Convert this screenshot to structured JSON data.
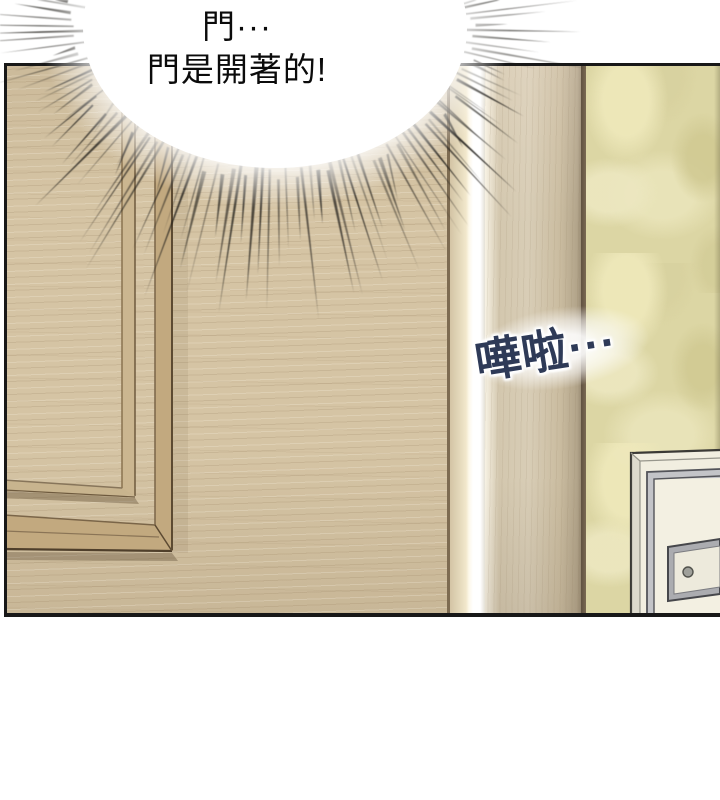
{
  "speech_bubble": {
    "lines": [
      "門···",
      "門是開著的!"
    ]
  },
  "sfx": {
    "text": "嘩啦···"
  },
  "theme": {
    "page_bg": "#ffffff",
    "panel_border": "#181818",
    "door_wood": "#d5c4a4",
    "door_grain": "#967e5c",
    "molding_face": "#c2a97f",
    "molding_line": "#5c4a32",
    "door_edge_light": "#f2e8cc",
    "light_gap": "#ffffff",
    "jamb_wood": "#d8cdb6",
    "jamb_trim": "#5f5140",
    "wallpaper_base": "#dcd6a4",
    "wallpaper_light": "#eee8ba",
    "wallpaper_dark": "#d0c992",
    "white_door_face": "#f1eee0",
    "metal_gray": "#c3c4c8",
    "sfx_ink": "#2e3a57",
    "burst_line": "#26241f",
    "speech_ink": "#0b0b0b"
  }
}
